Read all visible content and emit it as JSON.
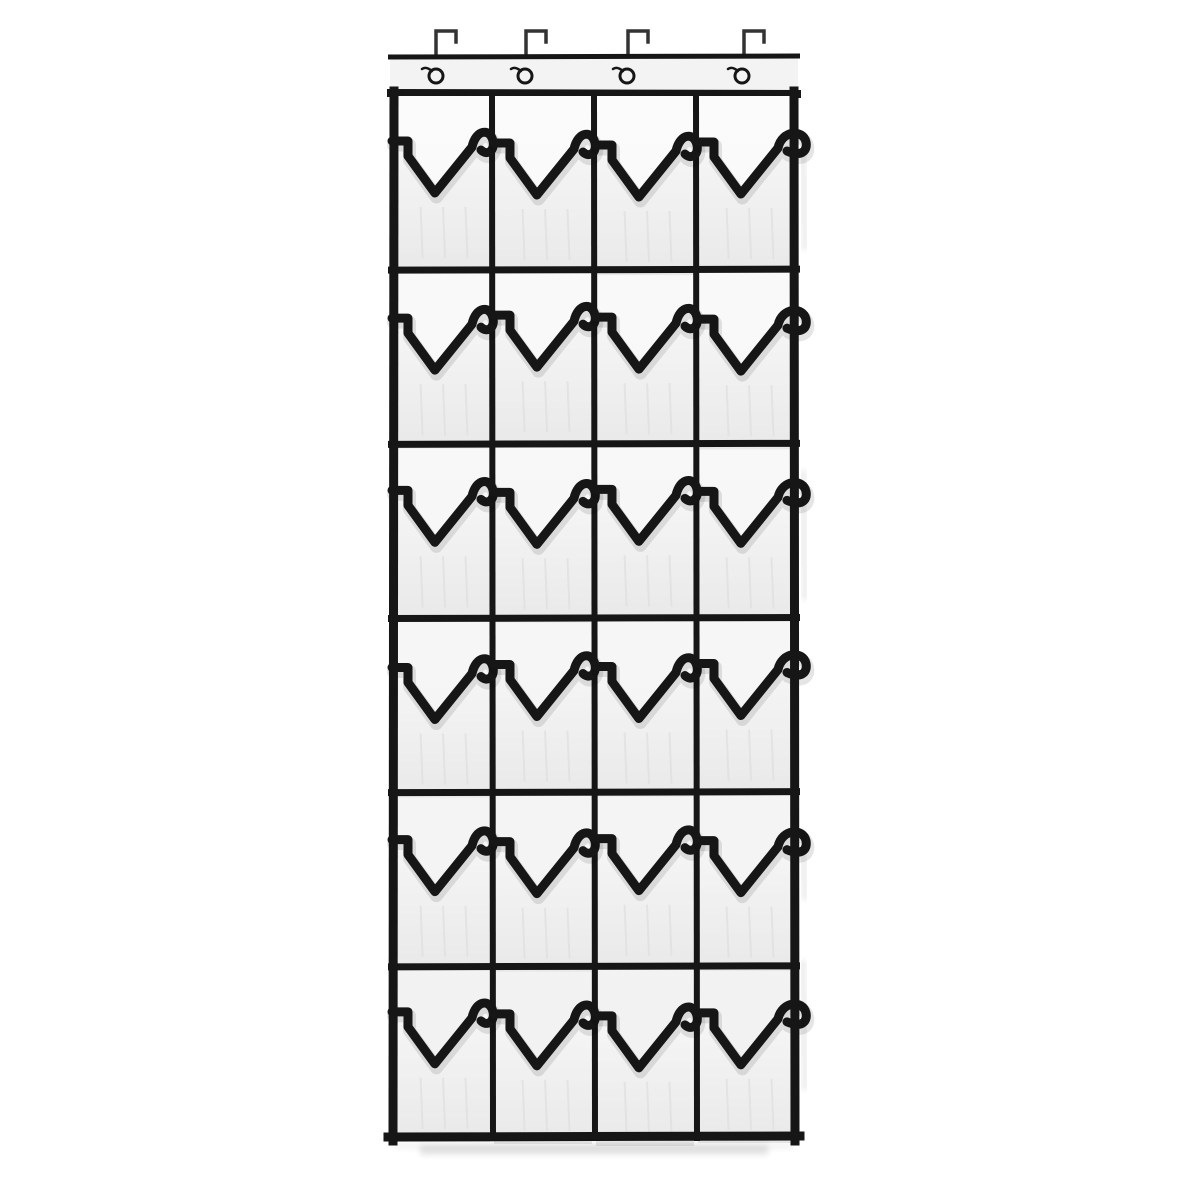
{
  "meta": {
    "description": "Product photo: white over-the-door hanging shoe organizer with black trim, 24 clear pockets in 6 rows of 4, hung on 4 metal over-door hooks",
    "background": "#ffffff"
  },
  "organizer": {
    "rows": 6,
    "columns": 4,
    "pocket_count": 24,
    "colors": {
      "ink": "#161616",
      "hook": "#333333",
      "band": "#f3f3f3",
      "back_top": "#fbfbfb",
      "back_bottom": "#f1f1f1",
      "pocket_top": "#f6f6f6",
      "pocket_bottom": "#e9e9e9",
      "crease": "#e2e2e2",
      "shadow": "rgba(0,0,0,0.10)"
    },
    "layout": {
      "left": 390,
      "right": 798,
      "band_top": 55,
      "band_bottom": 96,
      "body_bottom": 1141,
      "outer_stroke": 9,
      "divider_stroke": 6,
      "row_stroke": 7,
      "trim_stroke": 9
    },
    "hooks": {
      "count": 4,
      "x": [
        436,
        526,
        628,
        744
      ],
      "top_y": 31,
      "bar_w": 20,
      "lip_h": 11
    },
    "grommets": {
      "count": 4,
      "cx": [
        436,
        525,
        627,
        742
      ],
      "cy": 76,
      "r": 7
    }
  }
}
